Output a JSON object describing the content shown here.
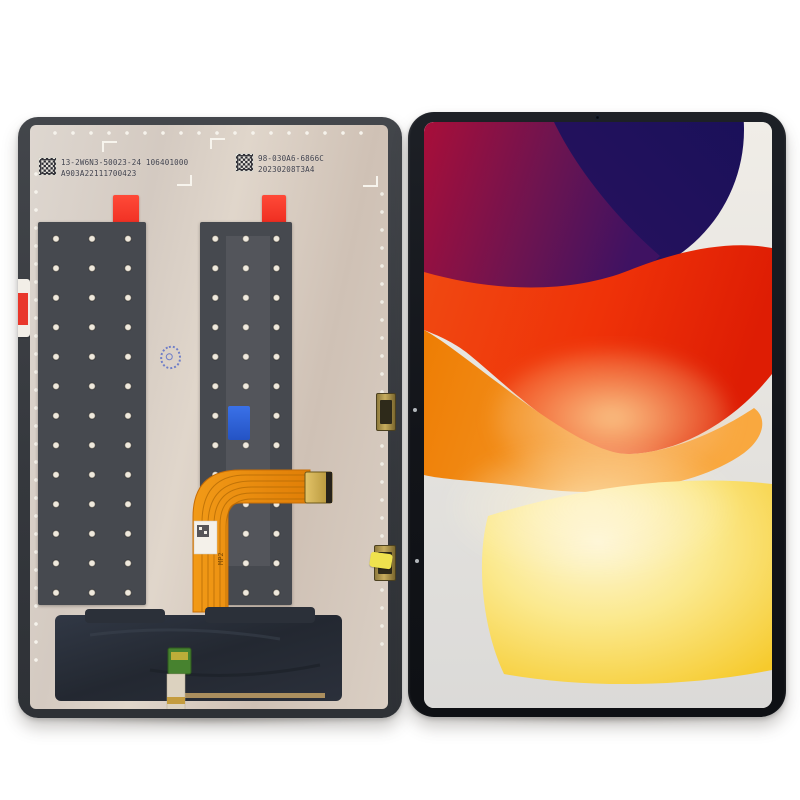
{
  "scene": {
    "description": "Tablet LCD display assembly replacement part, back view (left) and front view with wallpaper (right)",
    "background": "#ffffff"
  },
  "left_panel": {
    "name": "lcd-assembly-back",
    "frame_color": "#3a3d42",
    "surface_color": "#d7cdc3",
    "serial_labels": [
      {
        "line1": "13-2W6N3-50023-24 106401000",
        "line2": "A903A22111700423"
      },
      {
        "line1": "98-030A6-6866C",
        "line2": "20230208T3A4"
      }
    ],
    "strip_color": "#46494f",
    "red_tab_color": "#f43a2c",
    "blue_tab_color": "#2e63d9",
    "ink_stamp_color": "#4a62c9",
    "flex_cable": {
      "color": "#ee8b0d",
      "marking": "MP2",
      "connector_color": "#d2ae4e"
    },
    "bottom_cover_color": "#272c35",
    "pcb_color": "#47822f"
  },
  "right_panel": {
    "name": "tablet-front",
    "bezel_color": "#14161b",
    "wallpaper": {
      "background_top": "#f0ede7",
      "background_bottom": "#dbdad8",
      "navy_dark": "#141058",
      "navy_purple": "#2e1260",
      "magenta": "#a80e39",
      "purple": "#3f1262",
      "red_left": "#f04a12",
      "red_right": "#de1d04",
      "orange": "#ee7d03",
      "orange_light": "#f9a83f",
      "peach": "#fac486",
      "yellow": "#f6ca2c",
      "cream": "#fdf6d8"
    }
  }
}
